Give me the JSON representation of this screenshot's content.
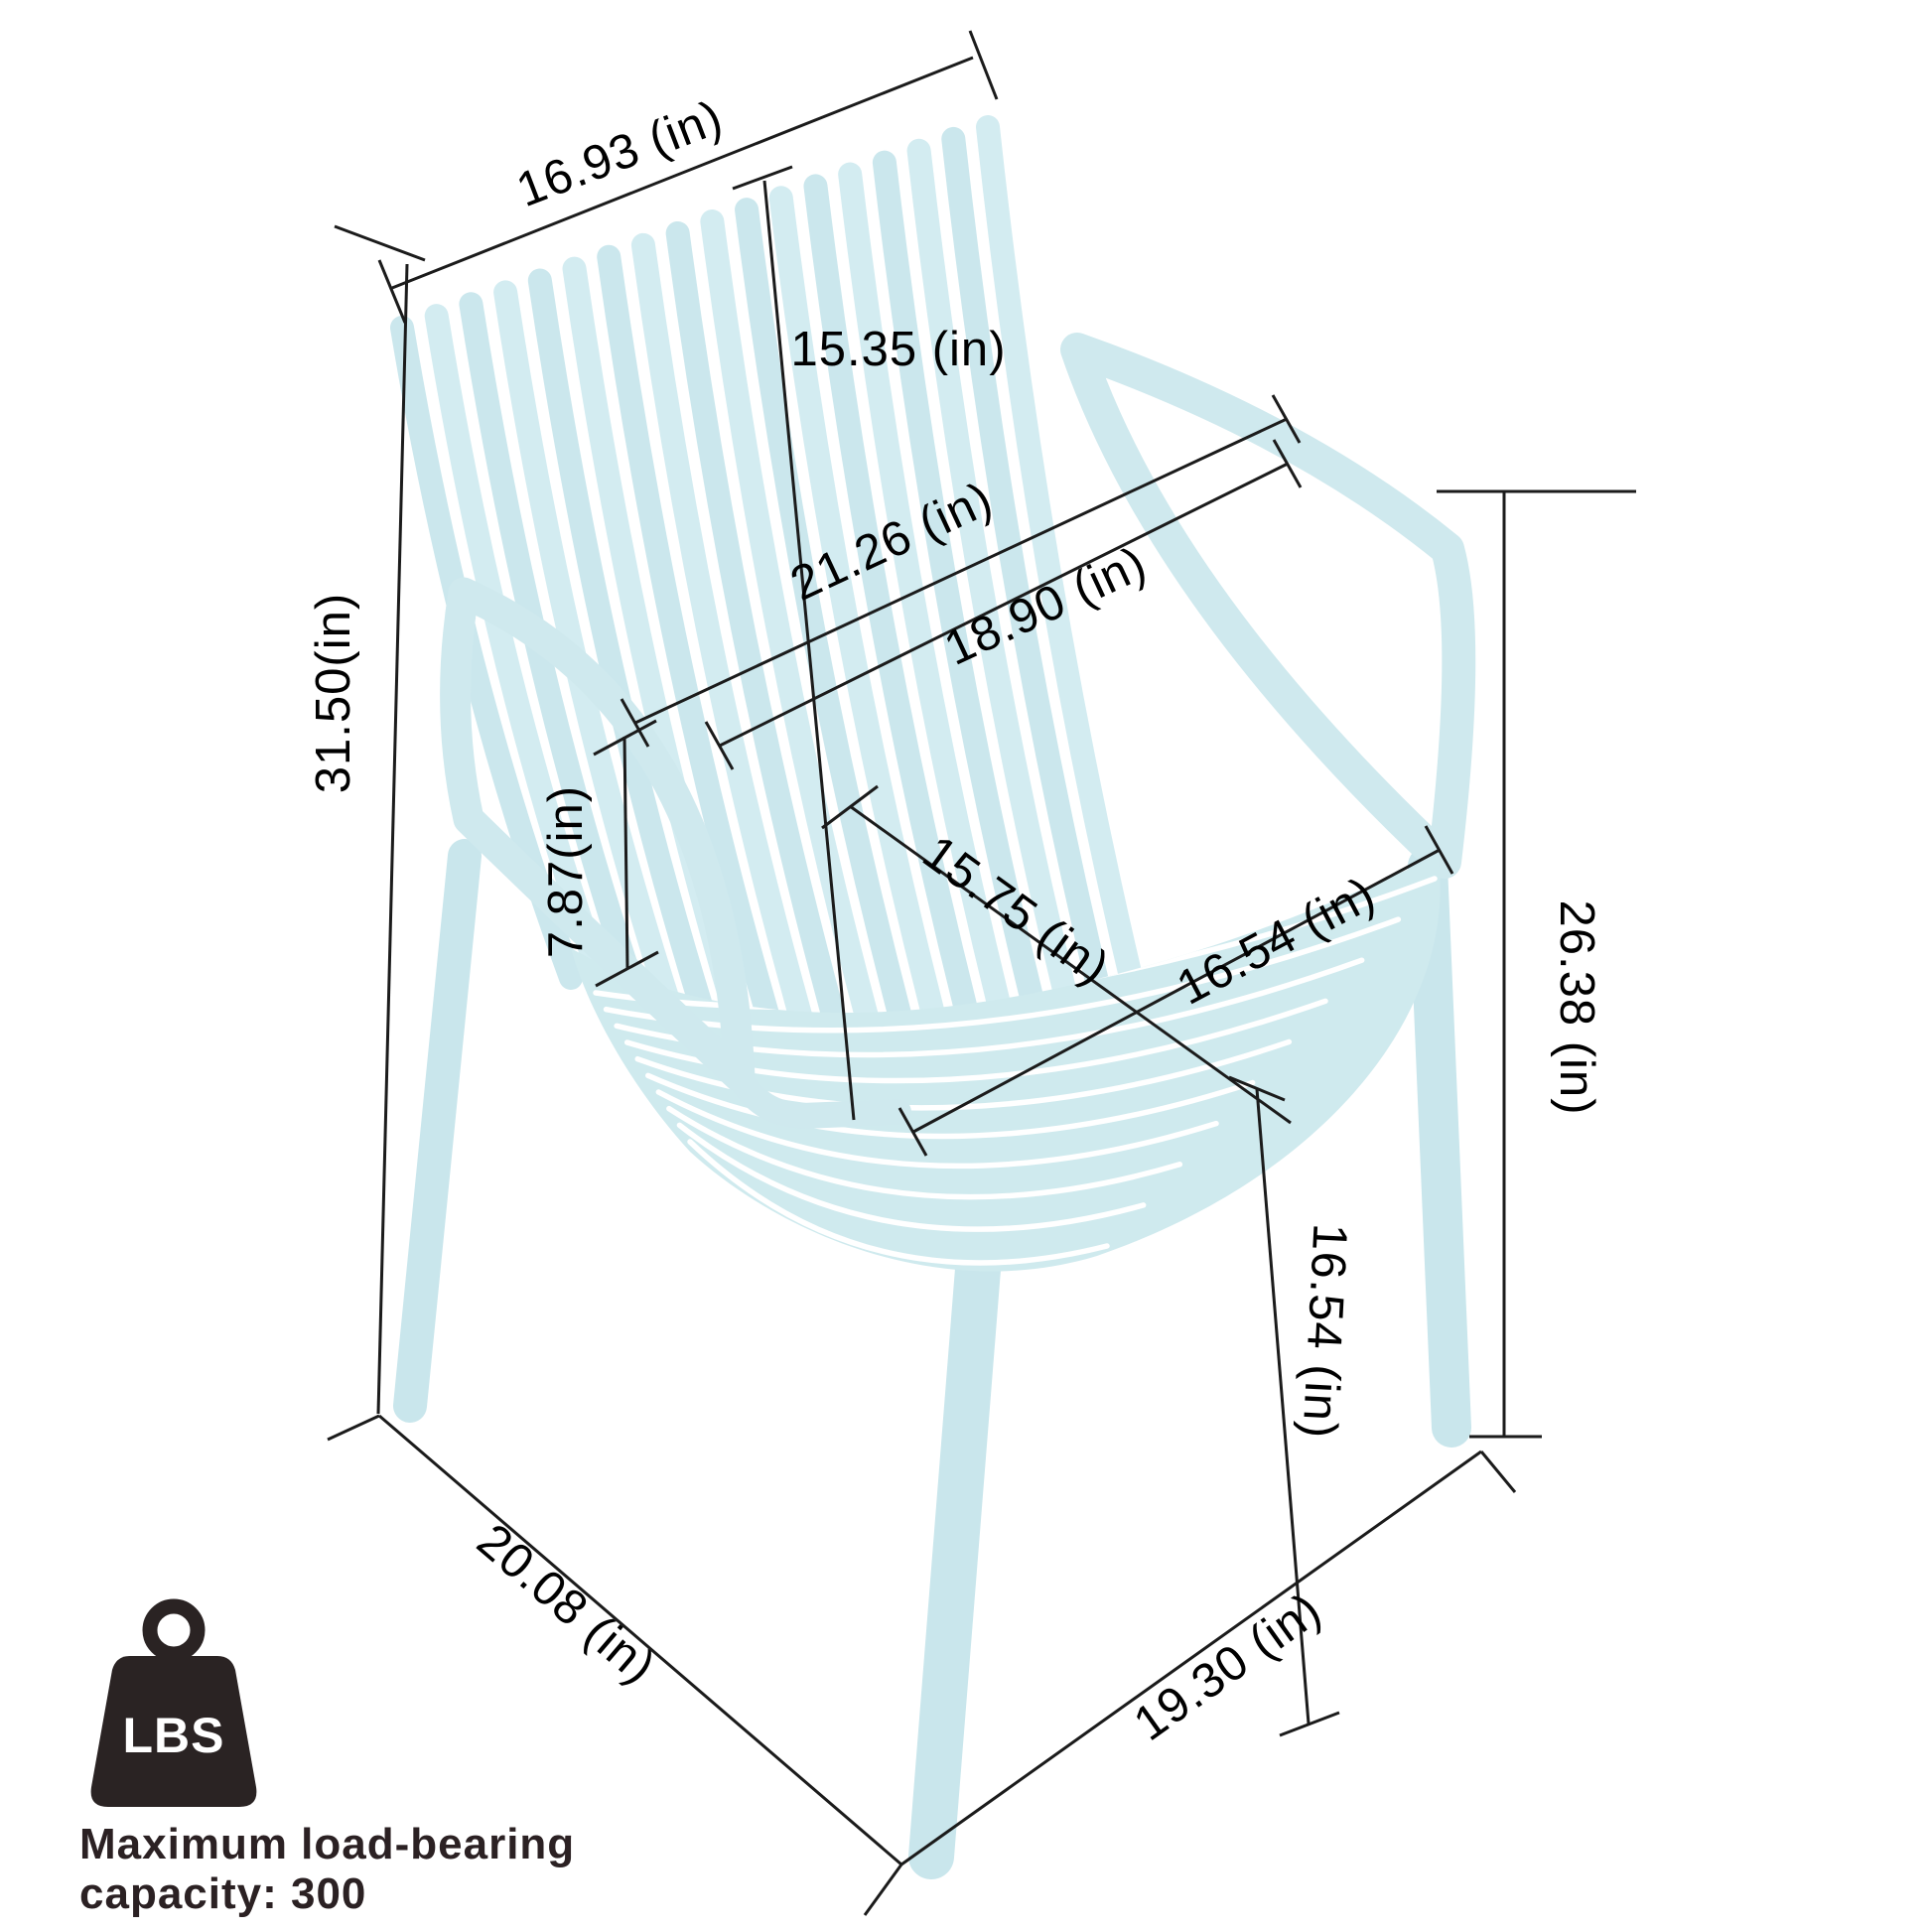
{
  "page": {
    "background": "#ffffff",
    "type": "product-dimension-diagram",
    "subject": "stackable slatted plastic armchair"
  },
  "chair": {
    "color": "#cfe9ee",
    "slat_color_a": "#cbe7ed",
    "slat_color_b": "#d3ecf1",
    "gap_color": "#ffffff"
  },
  "line_color": "#1b1b1b",
  "text_color": "#000000",
  "dims": {
    "back_top_width": {
      "value": 16.93,
      "unit": "in",
      "label": "16.93 (in)"
    },
    "back_height": {
      "value": 15.35,
      "unit": "in",
      "label": "15.35 (in)"
    },
    "armrest_span": {
      "value": 21.26,
      "unit": "in",
      "label": "21.26 (in)"
    },
    "seat_back_width": {
      "value": 18.9,
      "unit": "in",
      "label": "18.90 (in)"
    },
    "overall_height": {
      "value": 31.5,
      "unit": "in",
      "label": "31.50(in)"
    },
    "armrest_height": {
      "value": 7.87,
      "unit": "in",
      "label": "7.87(in)"
    },
    "seat_depth": {
      "value": 15.75,
      "unit": "in",
      "label": "15.75 (in)"
    },
    "seat_width": {
      "value": 16.54,
      "unit": "in",
      "label": "16.54 (in)"
    },
    "side_height": {
      "value": 26.38,
      "unit": "in",
      "label": "26.38 (in)"
    },
    "leg_height": {
      "value": 16.54,
      "unit": "in",
      "label": "16.54 (in)"
    },
    "base_depth": {
      "value": 20.08,
      "unit": "in",
      "label": "20.08 (in)"
    },
    "base_width": {
      "value": 19.3,
      "unit": "in",
      "label": "19.30 (in)"
    }
  },
  "capacity": {
    "icon_label": "LBS",
    "caption_line1": "Maximum load-bearing",
    "caption_line2": "capacity: 300",
    "max_load": 300
  }
}
